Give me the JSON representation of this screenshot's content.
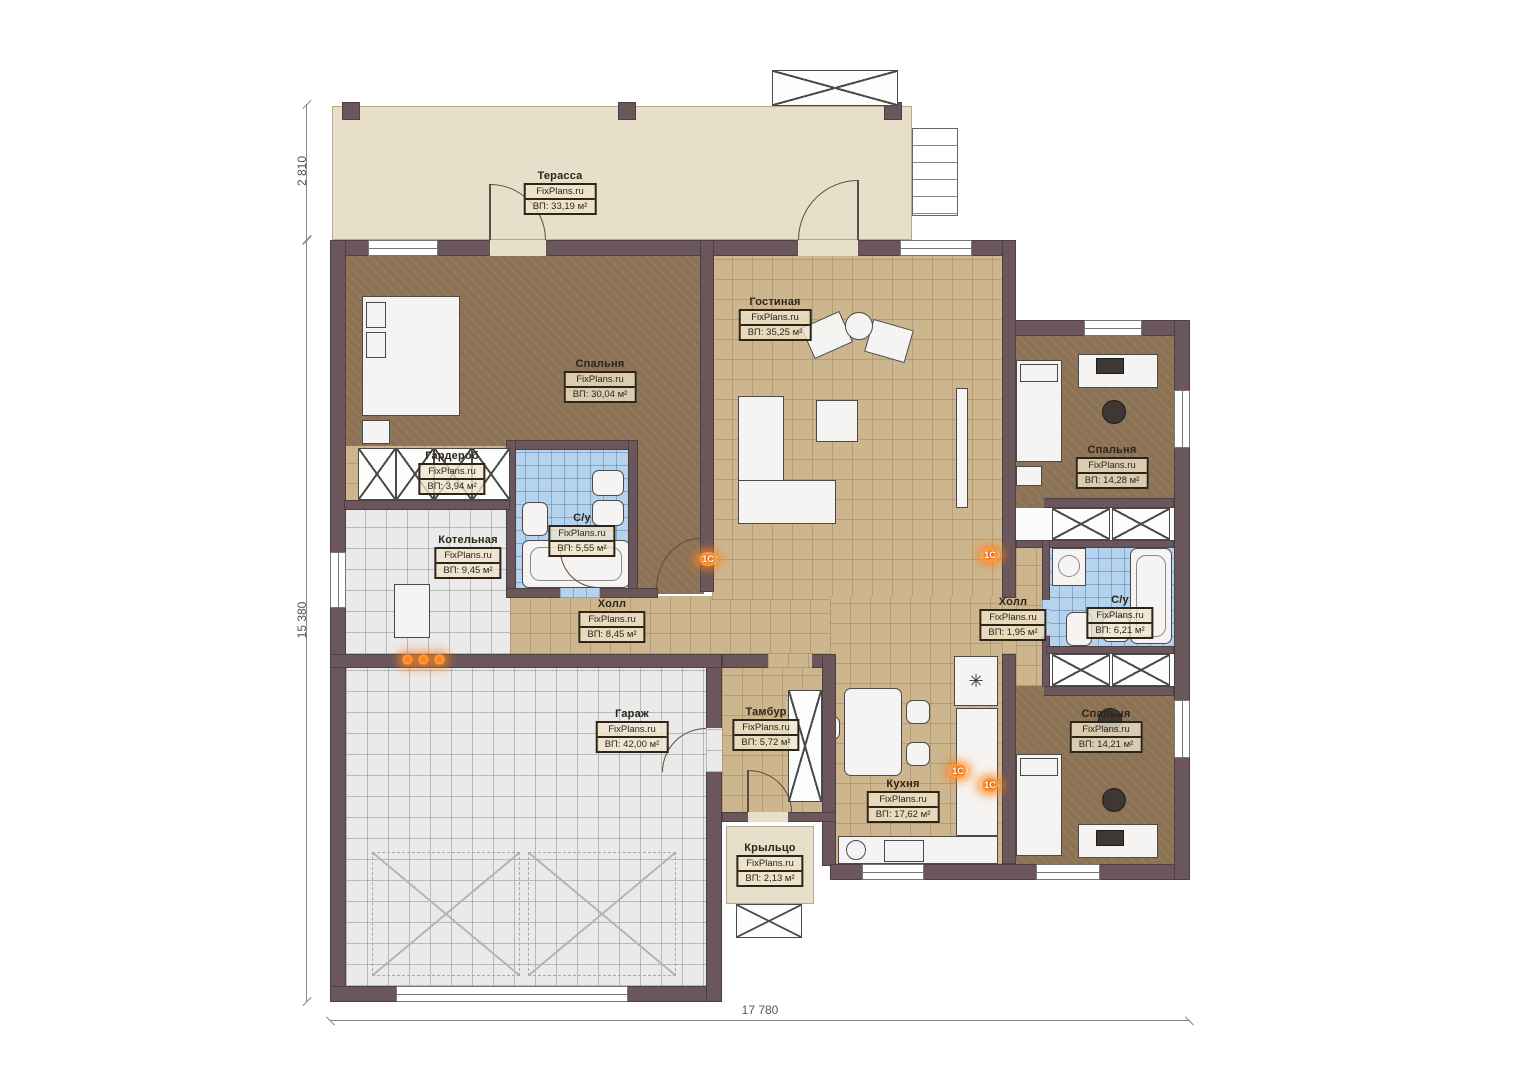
{
  "plan": {
    "brand": "FixPlans.ru",
    "marker_label": "1С",
    "icons": {
      "fridge_glyph": "✳"
    },
    "dimensions": {
      "terrace_depth": "2 810",
      "total_height": "15 380",
      "total_width": "17 780"
    },
    "rooms": {
      "terrace": {
        "name": "Терасса",
        "area": "ВП: 33,19 м²"
      },
      "bedroom1": {
        "name": "Спальня",
        "area": "ВП: 30,04 м²"
      },
      "living": {
        "name": "Гостиная",
        "area": "ВП: 35,25 м²"
      },
      "wardrobe": {
        "name": "Гардероб",
        "area": "ВП: 3,94 м²"
      },
      "bath1": {
        "name": "С/у",
        "area": "ВП: 5,55 м²"
      },
      "boiler": {
        "name": "Котельная",
        "area": "ВП: 9,45 м²"
      },
      "hall1": {
        "name": "Холл",
        "area": "ВП: 8,45 м²"
      },
      "bedroom2": {
        "name": "Спальня",
        "area": "ВП: 14,28 м²"
      },
      "hall2": {
        "name": "Холл",
        "area": "ВП: 1,95 м²"
      },
      "bath2": {
        "name": "С/у",
        "area": "ВП: 6,21 м²"
      },
      "garage": {
        "name": "Гараж",
        "area": "ВП: 42,00 м²"
      },
      "vestibule": {
        "name": "Тамбур",
        "area": "ВП: 5,72 м²"
      },
      "kitchen": {
        "name": "Кухня",
        "area": "ВП: 17,62 м²"
      },
      "bedroom3": {
        "name": "Спальня",
        "area": "ВП: 14,21 м²"
      },
      "porch": {
        "name": "Крыльцо",
        "area": "ВП: 2,13 м²"
      }
    }
  }
}
